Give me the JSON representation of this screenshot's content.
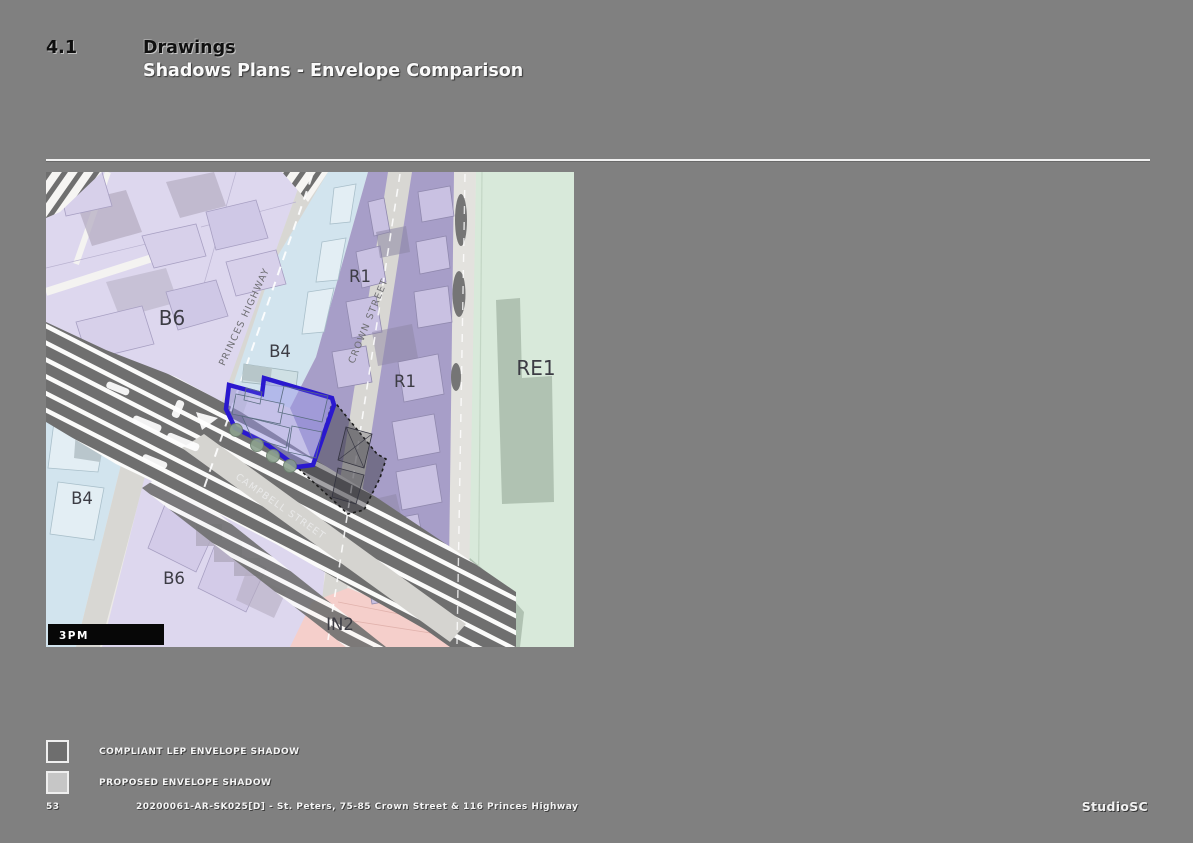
{
  "header": {
    "section_number": "4.1",
    "title": "Drawings",
    "subtitle": "Shadows Plans - Envelope Comparison"
  },
  "map": {
    "time_label": "3PM",
    "zone_labels": {
      "b6_top": "B6",
      "b4_top": "B4",
      "r1_top": "R1",
      "r1_mid": "R1",
      "re1": "RE1",
      "b4_left": "B4",
      "b6_bottom": "B6",
      "in2": "IN2"
    },
    "street_labels": {
      "princes_highway": "PRINCES HIGHWAY",
      "crown_street": "CROWN STREET",
      "campbell_street": "CAMPBELL STREET"
    },
    "colors": {
      "site_outline": "#2a18cf",
      "zone_b6": "#ddd7ee",
      "zone_b4": "#d2e4ee",
      "zone_r1": "#a79ec8",
      "zone_re1": "#d8e9da",
      "zone_in2": "#f5cfcb",
      "shadow_dark": "#6f6f6f"
    }
  },
  "legend": {
    "items": [
      {
        "label": "COMPLIANT LEP ENVELOPE SHADOW",
        "color": "#6e6e6e"
      },
      {
        "label": "PROPOSED ENVELOPE SHADOW",
        "color": "#c6c6c6"
      }
    ]
  },
  "footer": {
    "page_number": "53",
    "document_reference": "20200061-AR-SK025[D] - St. Peters, 75-85 Crown Street & 116 Princes Highway",
    "studio_logo": "StudioSC"
  }
}
